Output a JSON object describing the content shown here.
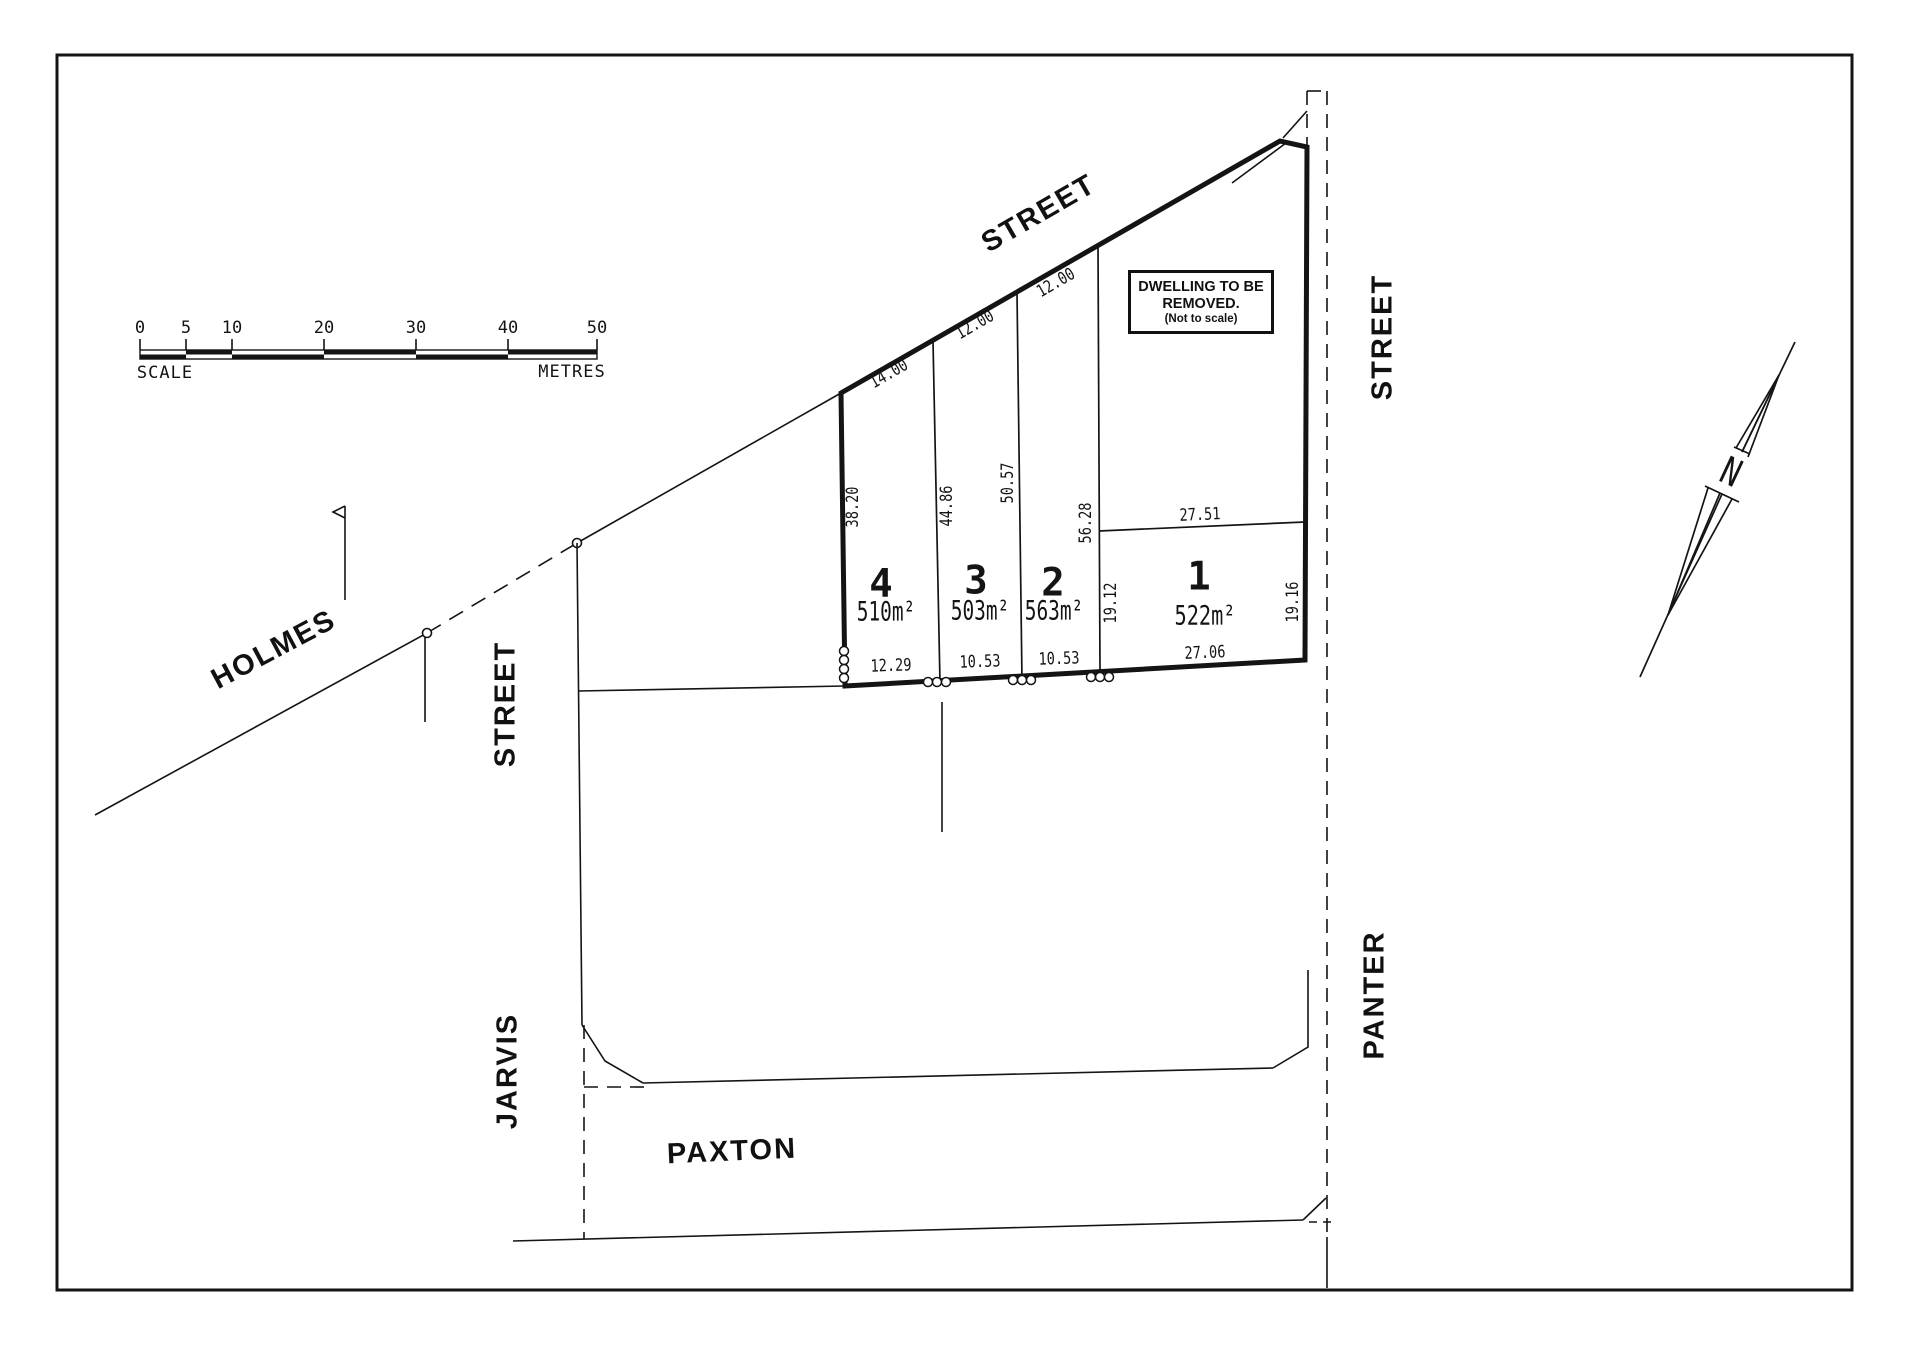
{
  "plan": {
    "colors": {
      "ink": "#141414",
      "paper": "#ffffff"
    },
    "north_label": "N",
    "scale_bar": {
      "tick_labels": [
        "0",
        "5",
        "10",
        "20",
        "30",
        "40",
        "50"
      ],
      "left_caption": "SCALE",
      "right_caption": "METRES"
    },
    "note_box": {
      "line1": "DWELLING TO BE",
      "line2": "REMOVED.",
      "line3": "(Not to scale)"
    },
    "streets": {
      "holmes_name": "HOLMES",
      "holmes_type": "STREET",
      "jarvis_name": "JARVIS",
      "jarvis_type": "STREET",
      "panter_name": "PANTER",
      "panter_type": "STREET",
      "paxton_name": "PAXTON",
      "paxton_type": "ROAD"
    },
    "lots": [
      {
        "number": "1",
        "area": "522m²"
      },
      {
        "number": "2",
        "area": "563m²"
      },
      {
        "number": "3",
        "area": "503m²"
      },
      {
        "number": "4",
        "area": "510m²"
      }
    ],
    "dimensions": {
      "lot4_frontage": "14.00",
      "lot3_frontage": "12.00",
      "lot2_frontage": "12.00",
      "lot4_west": "38.20",
      "lot4_lot3": "44.86",
      "lot3_lot2": "50.57",
      "lot2_lot1": "56.28",
      "lot1_north": "27.51",
      "lot1_west": "19.12",
      "lot1_east": "19.16",
      "lot4_rear": "12.29",
      "lot3_rear": "10.53",
      "lot2_rear": "10.53",
      "lot1_rear": "27.06"
    }
  }
}
